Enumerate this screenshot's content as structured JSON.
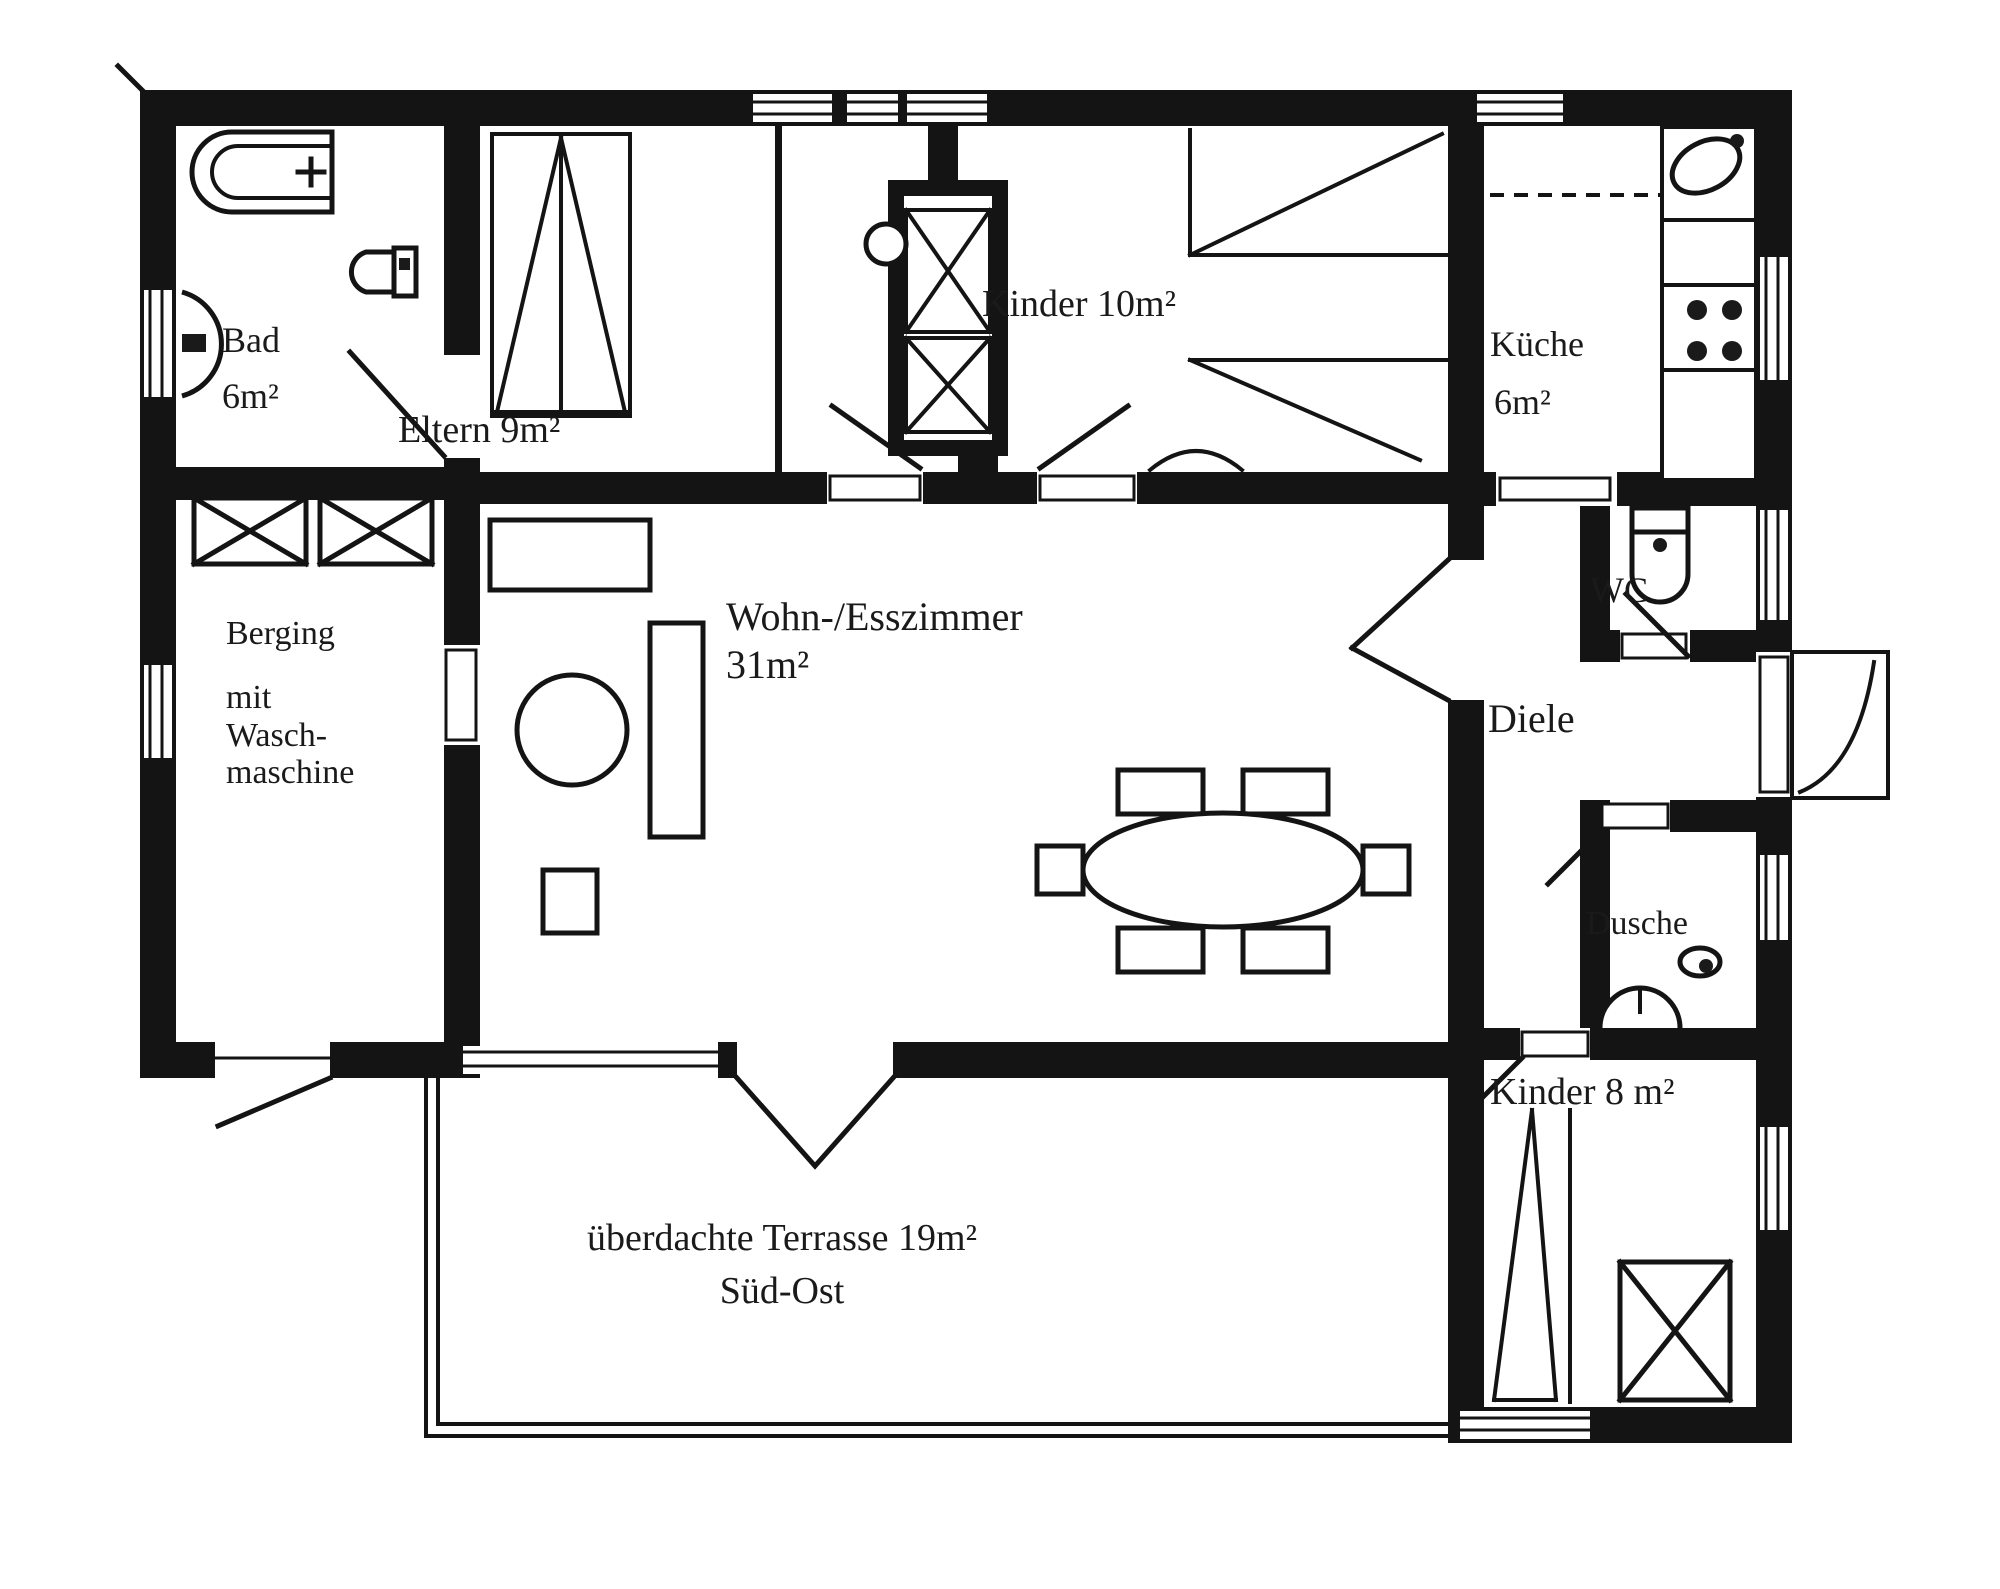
{
  "colors": {
    "ink": "#141414",
    "paper": "#ffffff"
  },
  "rooms": {
    "bad": {
      "name": "Bad",
      "area": "6m²"
    },
    "eltern": {
      "label": "Eltern  9m²"
    },
    "kinder10": {
      "label": "Kinder 10m²"
    },
    "kueche": {
      "name": "Küche",
      "area": "6m²"
    },
    "wc": {
      "label": "WC"
    },
    "diele": {
      "label": "Diele"
    },
    "dusche": {
      "label": "Dusche"
    },
    "kinder8": {
      "label": "Kinder 8 m²"
    },
    "berging": {
      "line1": "Berging",
      "line2": "mit",
      "line3": "Wasch-",
      "line4": "maschine"
    },
    "wohnzimmer": {
      "line1": "Wohn-/Esszimmer",
      "line2": "31m²"
    },
    "terrasse": {
      "line1": "überdachte Terrasse  19m²",
      "line2": "Süd-Ost"
    }
  }
}
